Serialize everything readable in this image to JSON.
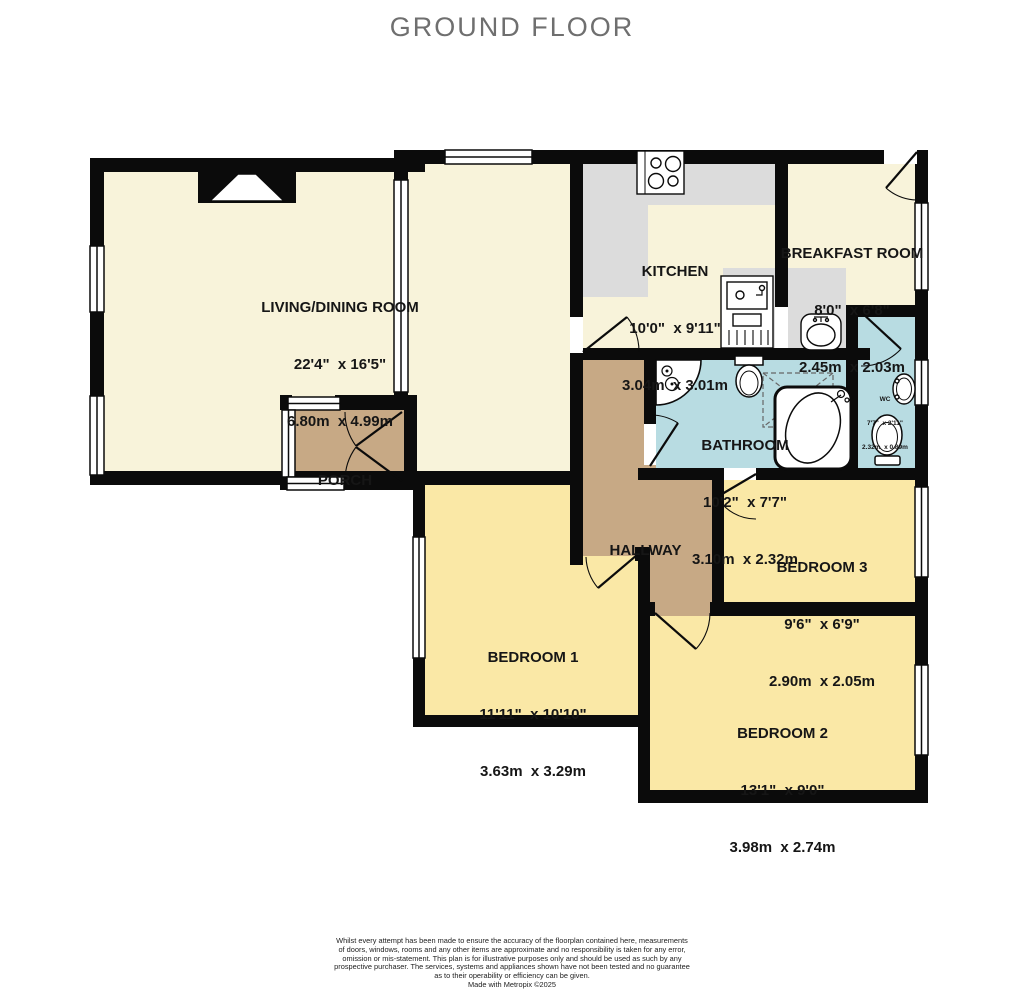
{
  "title": "GROUND FLOOR",
  "rooms": {
    "living": {
      "name": "LIVING/DINING ROOM",
      "imperial": "22'4\"  x 16'5\"",
      "metric": "6.80m  x 4.99m"
    },
    "porch": {
      "name": "PORCH"
    },
    "kitchen": {
      "name": "KITCHEN",
      "imperial": "10'0\"  x 9'11\"",
      "metric": "3.04m  x 3.01m"
    },
    "breakfast": {
      "name": "BREAKFAST ROOM",
      "imperial": "8'0\"  x 6'8\"",
      "metric": "2.45m  x 2.03m"
    },
    "bathroom": {
      "name": "BATHROOM",
      "imperial": "10'2\"  x 7'7\"",
      "metric": "3.10m  x 2.32m"
    },
    "wc": {
      "name": "WC",
      "imperial": "7'7\"  x 2'11\"",
      "metric": "2.32m  x 0.89m"
    },
    "hallway": {
      "name": "HALLWAY"
    },
    "bedroom1": {
      "name": "BEDROOM 1",
      "imperial": "11'11\"  x 10'10\"",
      "metric": "3.63m  x 3.29m"
    },
    "bedroom2": {
      "name": "BEDROOM 2",
      "imperial": "13'1\"  x 9'0\"",
      "metric": "3.98m  x 2.74m"
    },
    "bedroom3": {
      "name": "BEDROOM 3",
      "imperial": "9'6\"  x 6'9\"",
      "metric": "2.90m  x 2.05m"
    }
  },
  "palette": {
    "wall": "#0b0b0b",
    "cream_room": "#f8f3da",
    "bedroom_yellow": "#fae8a6",
    "wet_room_blue": "#b8dce2",
    "hall_tan": "#c7a985",
    "counter_gray": "#dcdcdc",
    "title_gray": "#6f6f6f"
  },
  "disclaimer": {
    "lines": [
      "Whilst every attempt has been made to ensure the accuracy of the floorplan contained here, measurements",
      "of doors, windows, rooms and any other items are approximate and no responsibility is taken for any error,",
      "omission or mis-statement. This plan is for illustrative purposes only and should be used as such by any",
      "prospective purchaser. The services, systems and appliances shown have not been tested and no guarantee",
      "as to their operability or efficiency can be given.",
      "Made with Metropix ©2025"
    ]
  }
}
